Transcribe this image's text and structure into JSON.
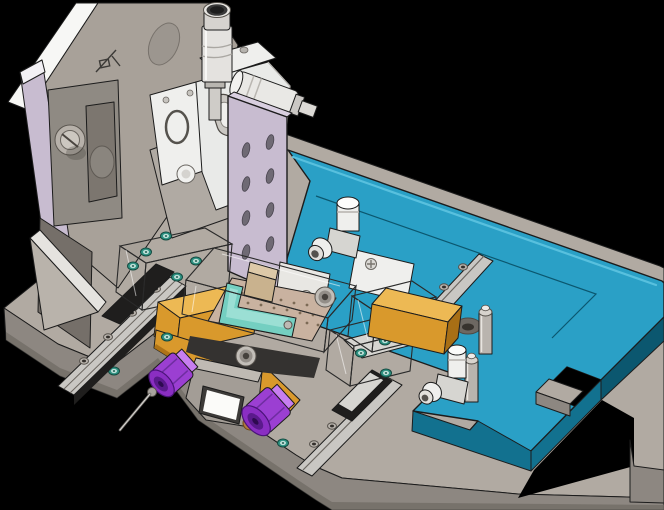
{
  "scene": {
    "description": "Isometric CAD render of a precision alignment fixture assembly",
    "view": "dimetric 3D viewport",
    "background_ref": "background"
  },
  "palette": {
    "background": "#000000",
    "outline": "#1c1c1c",
    "base_top": "#b1aaa2",
    "base_front": "#8d8781",
    "base_dark": "#6e6963",
    "teal_top": "#2aa0c6",
    "teal_light": "#58c0de",
    "teal_side": "#12718f",
    "teal_dark": "#0b576f",
    "lavender": "#c8bcd0",
    "lavender_dark": "#a79ab2",
    "white_part": "#efefed",
    "white_shade": "#d6d5d1",
    "white_dark": "#b5b4b0",
    "gray_block": "#8f8a83",
    "gray_dark": "#756f69",
    "sloped_gray": "#a8a199",
    "amber": "#d9992c",
    "amber_light": "#edb954",
    "amber_dark": "#a86f15",
    "tan_plate": "#c9b2a0",
    "tan_dot": "#7c6a55",
    "teal_part": "#74cfc1",
    "teal_part_light": "#a8e4da",
    "teal_part_dark": "#3f9f92",
    "purple": "#9b3fd2",
    "purple_dark": "#5f2391",
    "purple_light": "#c77ef0",
    "acrylic": "rgba(238,242,244,0.38)",
    "acrylic_edge": "#2a2a2a",
    "steel": "#c9c7c3",
    "steel_dark": "#8f8d89",
    "screw_green": "#2f9383",
    "screw_green_light": "#bfe0d9",
    "micrometer_cap": "#3a3a3a",
    "brass": "#b07a40",
    "black_part": "#1f1e1d"
  },
  "parts": [
    {
      "id": "base-plate",
      "label": "machined base plate",
      "color_ref": "base_top"
    },
    {
      "id": "top-plate",
      "label": "teal cover plate with L-notches",
      "color_ref": "teal_top"
    },
    {
      "id": "vertical-column",
      "label": "left column bracket with gusset",
      "color_ref": "gray_block"
    },
    {
      "id": "micrometer-vertical",
      "label": "vertical micrometer head",
      "color_ref": "white_part"
    },
    {
      "id": "micrometer-horizontal",
      "label": "horizontal micrometer head",
      "color_ref": "white_part"
    },
    {
      "id": "xy-stage",
      "label": "manual XY translation stage",
      "color_ref": "white_part"
    },
    {
      "id": "mount-plate",
      "label": "lavender mounting plate with slots",
      "color_ref": "lavender"
    },
    {
      "id": "acrylic-cover",
      "label": "transparent acrylic cover block",
      "color_ref": "acrylic"
    },
    {
      "id": "slide-plate",
      "label": "amber slide plate",
      "color_ref": "amber"
    },
    {
      "id": "vacuum-plate",
      "label": "vacuum chuck plate with hole grid",
      "color_ref": "tan_plate"
    },
    {
      "id": "sample-part",
      "label": "teal L-shaped workpiece",
      "color_ref": "teal_part"
    },
    {
      "id": "thumb-knob-left",
      "label": "purple thumb screw with probe needle",
      "color_ref": "purple"
    },
    {
      "id": "thumb-knob-right",
      "label": "purple thumb screw",
      "color_ref": "purple"
    },
    {
      "id": "sensor-block",
      "label": "slide block with white aperture",
      "color_ref": "gray_block"
    },
    {
      "id": "elbow-fitting-top",
      "label": "pneumatic elbow fitting",
      "color_ref": "white_part"
    },
    {
      "id": "elbow-fitting-bottom",
      "label": "pneumatic elbow fitting",
      "color_ref": "white_part"
    },
    {
      "id": "standoff-rear",
      "label": "cylindrical standoff post",
      "color_ref": "steel"
    },
    {
      "id": "standoff-front",
      "label": "cylindrical standoff post",
      "color_ref": "steel"
    },
    {
      "id": "linear-rail-left",
      "label": "linear guide rail",
      "color_ref": "steel"
    },
    {
      "id": "linear-rail-center",
      "label": "linear guide rail with carriage",
      "color_ref": "steel"
    },
    {
      "id": "linear-rail-right",
      "label": "linear guide rail",
      "color_ref": "steel"
    },
    {
      "id": "socket-screws",
      "label": "socket screws with teal heads",
      "color_ref": "screw_green"
    }
  ]
}
